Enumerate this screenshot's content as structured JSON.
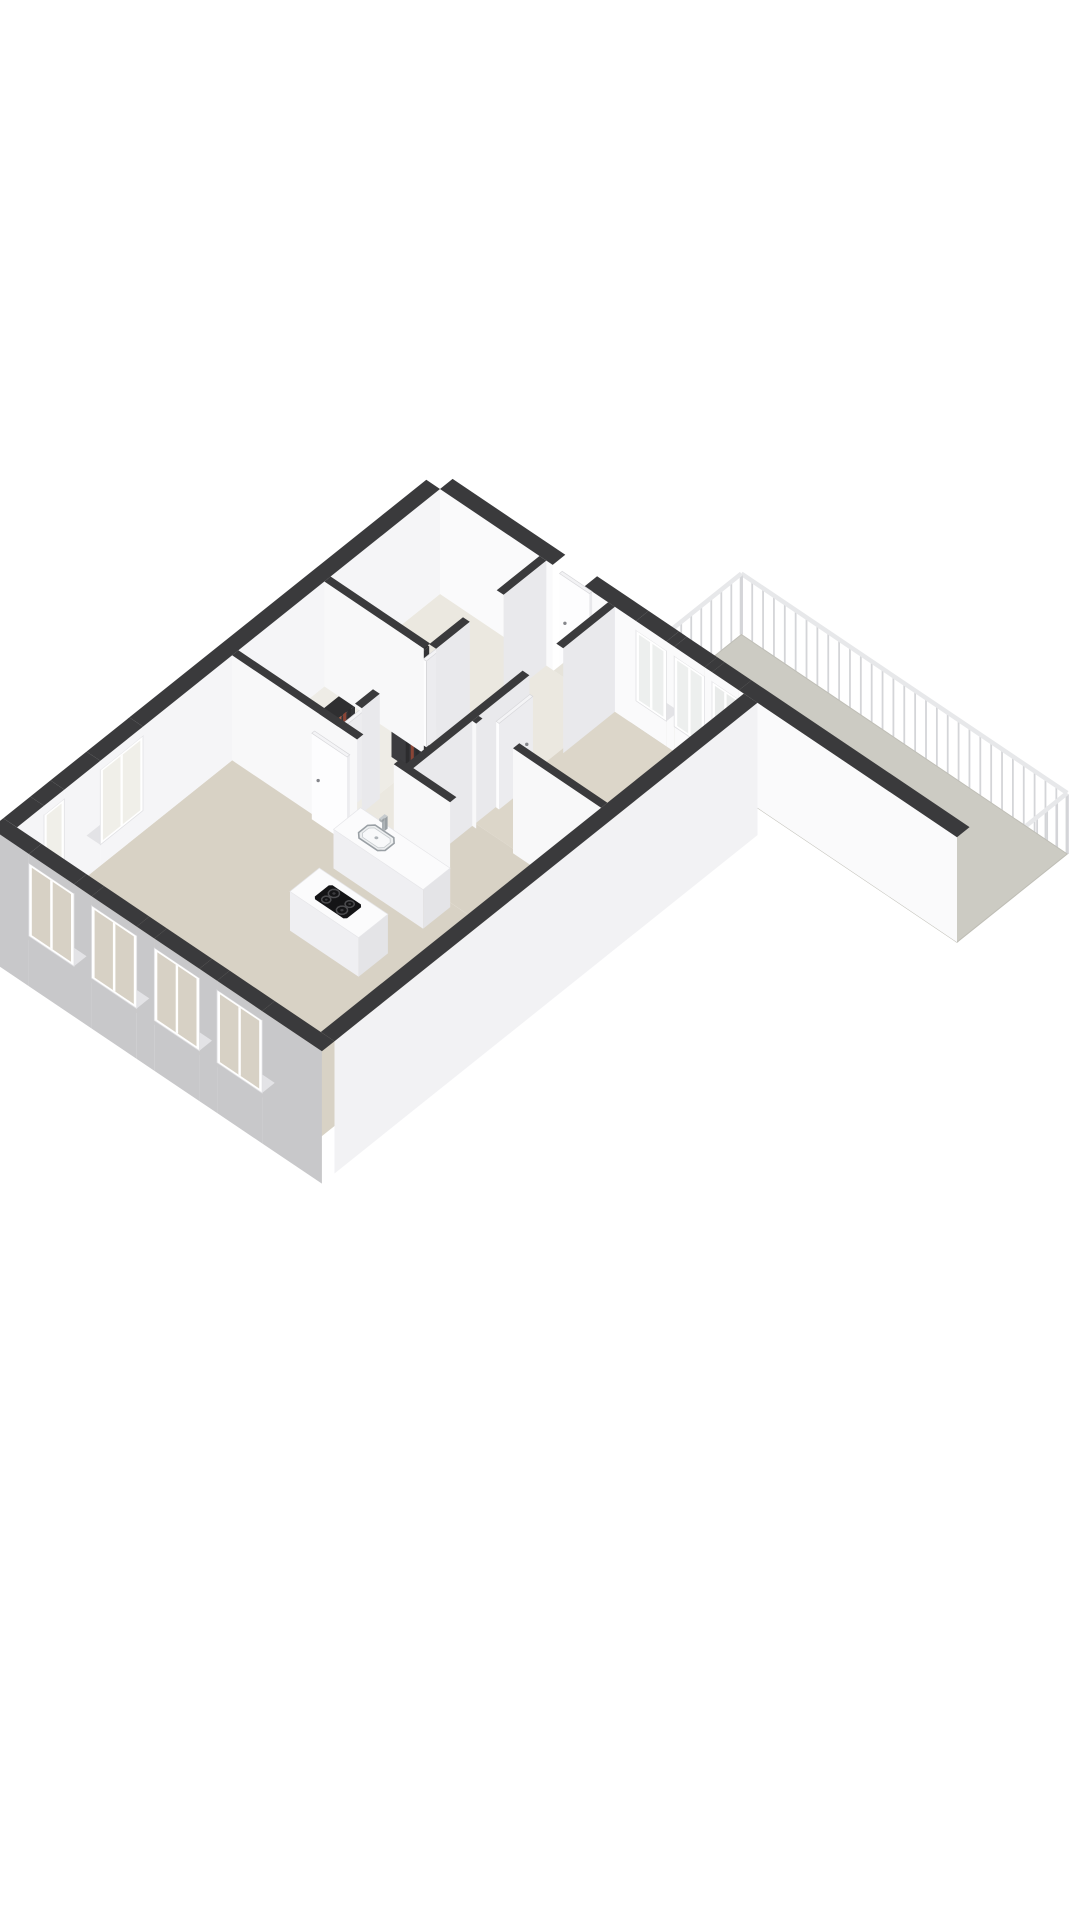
{
  "canvas": {
    "width": 1080,
    "height": 1920,
    "background": "#ffffff"
  },
  "projection": {
    "origin": [
      440,
      594
    ],
    "ax": [
      49,
      33
    ],
    "ay": [
      -45,
      36
    ],
    "up": 42,
    "cut": 2.5
  },
  "colors": {
    "background": "#ffffff",
    "wallTop": "#3a3a3c",
    "sillTop": "#e3e3e6",
    "frame": "#ffffff",
    "frameEdge": "#e1e1e4",
    "handle": "#85868b",
    "postColor": "#d4d5d8",
    "railColor": "#e7e8ea",
    "floorLiving": "#d8d2c5",
    "floorPale": "#ebe8e0",
    "balconyFloor": "#cccbc3",
    "pipeDark": "#2c2c2e",
    "pipeRed": "#8a4536",
    "steel": "#b9bec2",
    "cooktopBlack": "#141416",
    "burnerRing": "#4b4b4e"
  },
  "scene": [
    {
      "name": "balcony-railing",
      "type": "railing",
      "segments": [
        [
          3.9,
          -2.45,
          10.55,
          -2.45
        ],
        [
          10.55,
          -2.45,
          10.55,
          0
        ],
        [
          3.9,
          0,
          3.9,
          -2.45
        ]
      ],
      "height": 1.42,
      "postSpacing": 0.22
    },
    {
      "name": "balcony-floor",
      "type": "floor",
      "rect": [
        3.9,
        -2.45,
        10.55,
        0
      ],
      "fill": "#cccbc3",
      "edge": "#bfbeb6"
    },
    {
      "name": "balcony-wall",
      "type": "wall",
      "rect": [
        0,
        -0.28,
        10.55,
        0
      ],
      "faceColor": "#fafafb",
      "openings": [
        {
          "type": "door",
          "from": 2.3,
          "to": 2.95
        },
        {
          "type": "window",
          "from": 4.0,
          "to": 4.62,
          "sill": 0.6,
          "head": 2.28,
          "glass": "#edefee"
        },
        {
          "type": "window",
          "from": 4.78,
          "to": 5.4,
          "sill": 0.6,
          "head": 2.28,
          "glass": "#edefee"
        },
        {
          "type": "window",
          "from": 5.55,
          "to": 6.1,
          "sill": 0.05,
          "head": 2.28,
          "glass": "#e9ebea"
        }
      ]
    },
    {
      "name": "entrance-door",
      "type": "box",
      "rect": [
        2.32,
        -0.19,
        2.93,
        -0.13
      ],
      "h": 2.2,
      "top": "#f2f2f4",
      "front": "#fdfdfe",
      "side": "#e8e8eb",
      "outline": "#d8d8db",
      "handle": true
    },
    {
      "name": "entrance-threshold",
      "type": "floor",
      "rect": [
        2.32,
        -0.22,
        2.93,
        0
      ],
      "fill": "#e6e3da"
    },
    {
      "name": "floor-hall",
      "type": "floor",
      "rect": [
        2.1,
        0,
        3.5,
        4.55
      ],
      "fill": "#ebe8e0"
    },
    {
      "name": "floor-bedroom-left",
      "type": "floor",
      "rect": [
        0,
        0,
        2.1,
        2.5
      ],
      "fill": "#ebe8e0"
    },
    {
      "name": "floor-bathroom",
      "type": "floor",
      "rect": [
        0,
        2.5,
        2.1,
        4.55
      ],
      "fill": "#eeece6"
    },
    {
      "name": "floor-bedroom-right",
      "type": "floor",
      "rect": [
        3.5,
        0,
        6.2,
        3.1
      ],
      "fill": "#dcd6c9"
    },
    {
      "name": "floor-nook",
      "type": "floor",
      "rect": [
        3.5,
        3.1,
        6.2,
        4.55
      ],
      "fill": "#d8d2c5"
    },
    {
      "name": "floor-living-room",
      "type": "floor",
      "rect": [
        0,
        4.55,
        6.2,
        9.4
      ],
      "fill": "#d8d2c5"
    },
    {
      "name": "left-exterior-wall",
      "type": "wall",
      "rect": [
        -0.28,
        0,
        0,
        9.4
      ],
      "faceColor": "#f5f5f7",
      "openings": [
        {
          "type": "window",
          "from": 6.6,
          "to": 7.55,
          "sill": 0.5,
          "head": 2.28,
          "glass": "#f0efe9"
        },
        {
          "type": "window",
          "from": 8.35,
          "to": 8.8,
          "sill": 0.25,
          "head": 2.28,
          "glass": "#f0efe9"
        }
      ]
    },
    {
      "name": "shaft-back-1",
      "type": "box",
      "rect": [
        1.72,
        2.45,
        2.03,
        2.95
      ],
      "h": 2.45,
      "top": "#2f2f31",
      "front": "#3c3c3f",
      "side": "#333336"
    },
    {
      "name": "shaft-back-2",
      "type": "box",
      "rect": [
        1.72,
        4.1,
        2.03,
        4.55
      ],
      "h": 2.45,
      "top": "#2f2f31",
      "front": "#3c3c3f",
      "side": "#333336"
    },
    {
      "name": "shaft-pipes-1",
      "type": "pipes",
      "origin": [
        2.0,
        2.55
      ],
      "axis": "y",
      "offsets": [
        0,
        0.1,
        0.21,
        0.32
      ],
      "pipeColors": [
        "#2c2c2e",
        "#2c2c2e",
        "#8a4536",
        "#2c2c2e"
      ],
      "w": 0.07,
      "h": 2.42
    },
    {
      "name": "shaft-pipes-2",
      "type": "pipes",
      "origin": [
        2.0,
        4.16
      ],
      "axis": "y",
      "offsets": [
        0,
        0.1,
        0.21,
        0.3
      ],
      "pipeColors": [
        "#2c2c2e",
        "#8a4536",
        "#a85f49",
        "#2c2c2e"
      ],
      "w": 0.07,
      "h": 2.42
    },
    {
      "name": "door-bedroom-left",
      "type": "box",
      "rect": [
        1.91,
        1.7,
        1.97,
        2.45
      ],
      "h": 2.05,
      "top": "#f4f4f6",
      "front": "#fdfdfe",
      "side": "#ececef",
      "outline": "#d8d8db",
      "handle": true
    },
    {
      "name": "door-bathroom",
      "type": "box",
      "rect": [
        1.91,
        3.7,
        1.97,
        4.45
      ],
      "h": 2.05,
      "top": "#f4f4f6",
      "front": "#fdfdfe",
      "side": "#ececef",
      "outline": "#d8d8db",
      "handle": true
    },
    {
      "name": "bathroom-wall",
      "type": "wall",
      "rect": [
        0,
        2.43,
        2.03,
        2.57
      ],
      "faceColor": "#f8f8f9",
      "openings": []
    },
    {
      "name": "hall-wall-left",
      "type": "wall",
      "rect": [
        2.03,
        0,
        2.17,
        4.55
      ],
      "faceColor": "#e9e9ec",
      "openings": [
        {
          "type": "door",
          "from": 0.95,
          "to": 1.7
        },
        {
          "type": "door",
          "from": 2.45,
          "to": 2.95
        },
        {
          "type": "door",
          "from": 2.95,
          "to": 3.7
        },
        {
          "type": "door",
          "from": 4.1,
          "to": 4.55
        }
      ]
    },
    {
      "name": "hall-wall-right",
      "type": "wall",
      "rect": [
        3.43,
        0,
        3.57,
        4.55
      ],
      "faceColor": "#e9e9ec",
      "openings": [
        {
          "type": "door",
          "from": 1.15,
          "to": 1.9
        }
      ]
    },
    {
      "name": "door-bedroom-right",
      "type": "box",
      "rect": [
        3.58,
        1.9,
        3.64,
        2.65
      ],
      "h": 2.05,
      "top": "#f4f4f6",
      "front": "#fdfdfe",
      "side": "#ececef",
      "outline": "#d8d8db",
      "handle": true
    },
    {
      "name": "door-nook",
      "type": "box",
      "rect": [
        4.4,
        2.95,
        5.15,
        3.01
      ],
      "h": 2.05,
      "top": "#f4f4f6",
      "front": "#fdfdfe",
      "side": "#ececef",
      "outline": "#d8d8db",
      "handle": true
    },
    {
      "name": "bedroom-right-wall",
      "type": "wall",
      "rect": [
        3.57,
        3.03,
        6.2,
        3.17
      ],
      "faceColor": "#f8f8f9",
      "openings": [
        {
          "type": "door",
          "from": 3.65,
          "to": 4.4
        }
      ]
    },
    {
      "name": "kitchen-wall",
      "type": "wall",
      "rect": [
        0,
        4.48,
        4.45,
        4.62
      ],
      "faceColor": "#f8f8f9",
      "openings": [
        {
          "type": "door",
          "from": 2.55,
          "to": 3.3
        }
      ]
    },
    {
      "name": "door-living",
      "type": "box",
      "rect": [
        1.7,
        4.64,
        2.42,
        4.7
      ],
      "h": 2.05,
      "top": "#f4f4f6",
      "front": "#fdfdfe",
      "side": "#ececef",
      "outline": "#d8d8db",
      "handle": true
    },
    {
      "name": "kitchen-counter",
      "type": "box",
      "rect": [
        2.62,
        4.62,
        4.45,
        5.22
      ],
      "h": 0.93,
      "top": "#fbfbfc",
      "front": "#efeff2",
      "side": "#e4e4e7",
      "outline": "#e6e6e9"
    },
    {
      "name": "kitchen-sink",
      "type": "flat",
      "kind": "sink",
      "rect": [
        2.95,
        4.74,
        3.49,
        5.1
      ],
      "z": 0.94
    },
    {
      "name": "faucet",
      "type": "box",
      "rect": [
        3.15,
        4.66,
        3.21,
        4.72
      ],
      "z0": 0.93,
      "h": 0.3,
      "top": "#c6cbce",
      "front": "#aab0b4",
      "side": "#9aa0a4"
    },
    {
      "name": "faucet-spout",
      "type": "box",
      "rect": [
        3.15,
        4.72,
        3.2,
        4.78
      ],
      "z0": 1.17,
      "h": 0.06,
      "top": "#c6cbce",
      "front": "#aab0b4",
      "side": "#9aa0a4"
    },
    {
      "name": "kitchen-island",
      "type": "box",
      "rect": [
        3.0,
        5.95,
        4.4,
        6.6
      ],
      "h": 0.93,
      "top": "#fbfbfc",
      "front": "#efeff2",
      "side": "#e4e4e7",
      "outline": "#e6e6e9"
    },
    {
      "name": "cooktop",
      "type": "flat",
      "kind": "cooktop",
      "rect": [
        3.35,
        6.08,
        4.01,
        6.47
      ],
      "z": 0.94
    },
    {
      "name": "bench-low-1",
      "type": "box",
      "rect": [
        4.55,
        8.52,
        5.25,
        8.82
      ],
      "h": 0.5,
      "top": "#fbfbfc",
      "front": "#efeff2",
      "side": "#e4e4e7"
    },
    {
      "name": "bench-low-2",
      "type": "box",
      "rect": [
        5.42,
        7.95,
        5.82,
        8.2
      ],
      "h": 0.35,
      "top": "#fbfbfc",
      "front": "#efeff2",
      "side": "#e4e4e7"
    },
    {
      "name": "right-exterior-wall",
      "type": "wall",
      "rect": [
        6.2,
        0,
        6.48,
        9.4
      ],
      "faceColor": "#f2f2f4",
      "base": -0.65,
      "openings": []
    },
    {
      "name": "front-facade-wall",
      "type": "wall",
      "rect": [
        -0.28,
        9.4,
        6.48,
        9.68
      ],
      "faceColor": "#c8c8ca",
      "base": -0.65,
      "openings": [
        {
          "type": "window",
          "from": 0.5,
          "to": 1.42,
          "sill": 0.55,
          "head": 2.28,
          "glass": "#d7d1c5"
        },
        {
          "type": "window",
          "from": 1.78,
          "to": 2.7,
          "sill": 0.55,
          "head": 2.28,
          "glass": "#d7d1c5"
        },
        {
          "type": "window",
          "from": 3.06,
          "to": 3.98,
          "sill": 0.55,
          "head": 2.28,
          "glass": "#d7d1c5"
        },
        {
          "type": "window",
          "from": 4.34,
          "to": 5.26,
          "sill": 0.55,
          "head": 2.28,
          "glass": "#d7d1c5"
        }
      ]
    }
  ]
}
